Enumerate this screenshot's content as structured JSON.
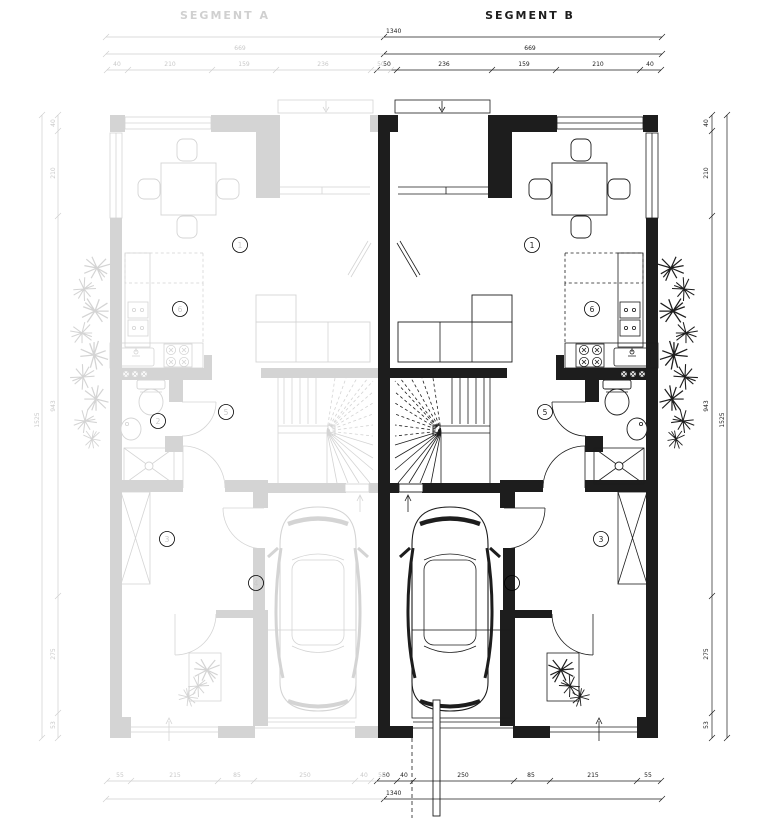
{
  "header": {
    "segment_a": "SEGMENT A",
    "segment_b": "SEGMENT B"
  },
  "rooms_b": {
    "living": "1",
    "kitchen": "6",
    "hall": "5",
    "room3": "3",
    "garage": "4"
  },
  "rooms_a": {
    "living": "1",
    "kitchen": "6",
    "wc": "2",
    "hall": "5",
    "room3": "3",
    "garage": "4"
  },
  "dims": {
    "top_total": "1340",
    "top_overall": "669",
    "top_overall_a": "669",
    "top_parts": [
      "50",
      "236",
      "159",
      "210",
      "40"
    ],
    "top_parts_a": [
      "40",
      "210",
      "159",
      "236",
      "50"
    ],
    "bottom_total": "1340",
    "bottom_parts": [
      "50",
      "40",
      "250",
      "85",
      "215",
      "55"
    ],
    "bottom_parts_a": [
      "55",
      "215",
      "85",
      "250",
      "40",
      "50"
    ],
    "right_total": "1525",
    "right_parts": [
      "40",
      "210",
      "943",
      "275",
      "53"
    ],
    "left_total": "1525",
    "left_parts": [
      "40",
      "210",
      "943",
      "275",
      "53"
    ]
  }
}
